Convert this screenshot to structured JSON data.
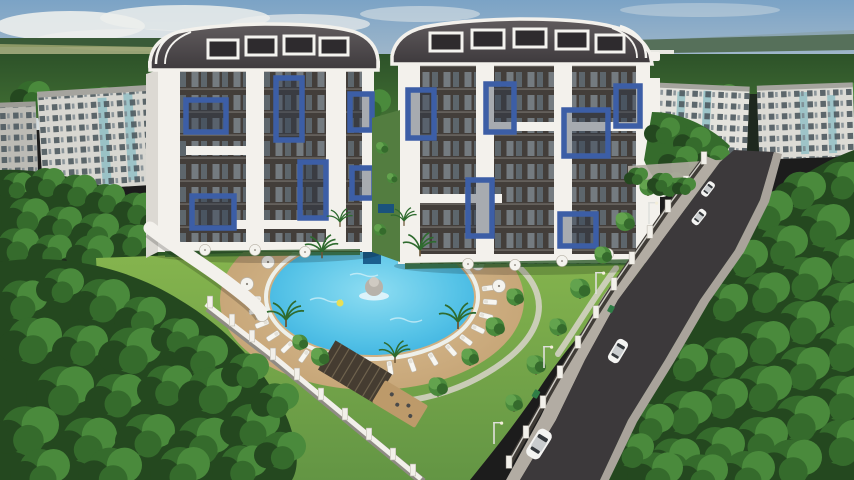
{
  "meta": {
    "domain": "natural-image",
    "subject": "aerial 3d architectural rendering of a residential complex",
    "visible_text": "none (faint illegible watermark only)"
  },
  "palette": {
    "sky_top": "#7ba3c6",
    "sky_mid": "#a9bccb",
    "sky_low": "#d9e0e2",
    "cloud": "#eceeec",
    "distant_hill": "#8aa3ad",
    "distant_field": "#97a06b",
    "distant_forest": "#3a5a38",
    "forest_dark": "#24481f",
    "forest_mid": "#356b2c",
    "forest_light": "#4a8a3c",
    "tree_highlight": "#63a34e",
    "lawn_light": "#86b54e",
    "lawn_dark": "#639544",
    "deck": "#bd9a6a",
    "deck_light": "#dcc096",
    "pool_deep": "#2fa8dc",
    "pool_mid": "#56c3e7",
    "pool_light": "#8eddf2",
    "pool_feature": "#1b5f8e",
    "road": "#3c393b",
    "sidewalk": "#b2aca3",
    "curb": "#a9a39b",
    "wall_white": "#f2f0ea",
    "wall_dark": "#403c37",
    "facade": "#433e3a",
    "facade_window": "#7d868c",
    "frame_white": "#f3f1ec",
    "accent_blue": "#3c5ea6",
    "roof_top": "#615c5e",
    "roof_bottom": "#3e3a3d",
    "bg_wall": "#d8d7d1",
    "bg_wall_shade": "#bcbbb5",
    "bg_window": "#4e5a60",
    "glass_teal": "#8fbec4",
    "car_white": "#f4f4f2",
    "car_glass": "#35393d",
    "bin_green": "#2f7d46",
    "path": "#d8d3ca",
    "fountain_gray": "#b7b2aa",
    "float_yellow": "#e8df55"
  },
  "scene": {
    "sky": {
      "clouds": 6
    },
    "background_buildings": {
      "left_blocks": 2,
      "right_blocks": 2,
      "style": "older panel apartment blocks with teal glazed balconies",
      "floors": 5
    },
    "towers": {
      "count": 2,
      "floors": 8,
      "roof": "curved barrel roof with dormer windows and white trim",
      "facade": "dark facade, white frame piers, blue balcony frames",
      "blue_frames_left_tower": 6,
      "blue_frames_right_tower": 6
    },
    "pool": {
      "shape": "oval with scalloped lounger ring",
      "features": [
        "central tiered fountain",
        "waterfall inlet",
        "yellow float"
      ],
      "loungers_ring": 18,
      "loungers_top_row": 7,
      "umbrellas_poolside": 9,
      "umbrellas_terrace": 7
    },
    "road": {
      "cars": 4,
      "street_lamps": 5,
      "trash_bins": 2,
      "wall_pillars": 22
    },
    "grounds": {
      "palms": 7,
      "garden_trees": 13,
      "pergolas": 2,
      "perimeter": "white fence wall with pillars",
      "entrance_canopy": "long white curved canopy"
    }
  }
}
